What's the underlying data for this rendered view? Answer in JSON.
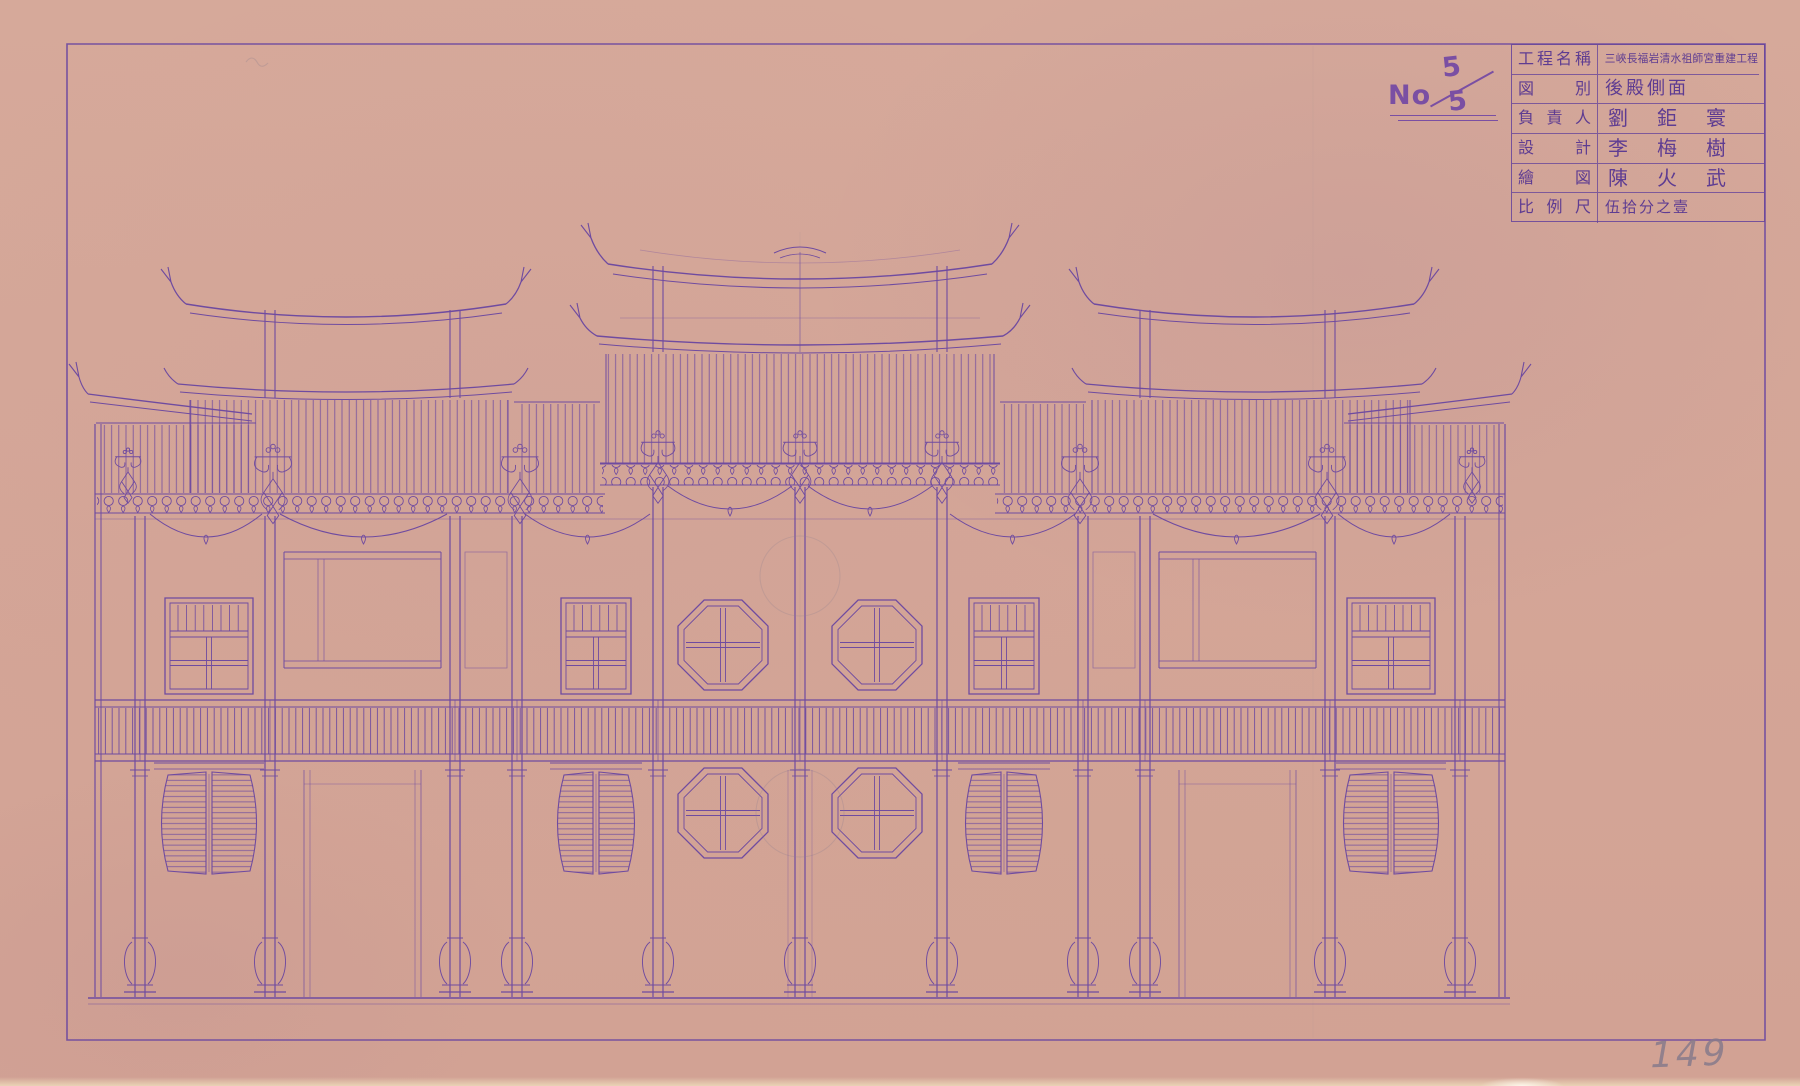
{
  "sheet": {
    "no_label": "No",
    "sheet_index": "5",
    "sheet_total": "5",
    "page_number": "149"
  },
  "title_block": {
    "rows": [
      {
        "label": "工程名稱",
        "value": "三峽長福岩清水祖師宮重建工程"
      },
      {
        "label": "図別",
        "value": "後殿側面"
      },
      {
        "label": "負責人",
        "value": "劉鉅寰"
      },
      {
        "label": "設計",
        "value": "李梅樹"
      },
      {
        "label": "繪図",
        "value": "陳火武"
      },
      {
        "label": "比例尺",
        "value": "伍拾分之壹"
      }
    ]
  },
  "colors": {
    "paper": "#d5a797",
    "ink": "#6f4ba0",
    "pencil": "#8d7f90"
  }
}
